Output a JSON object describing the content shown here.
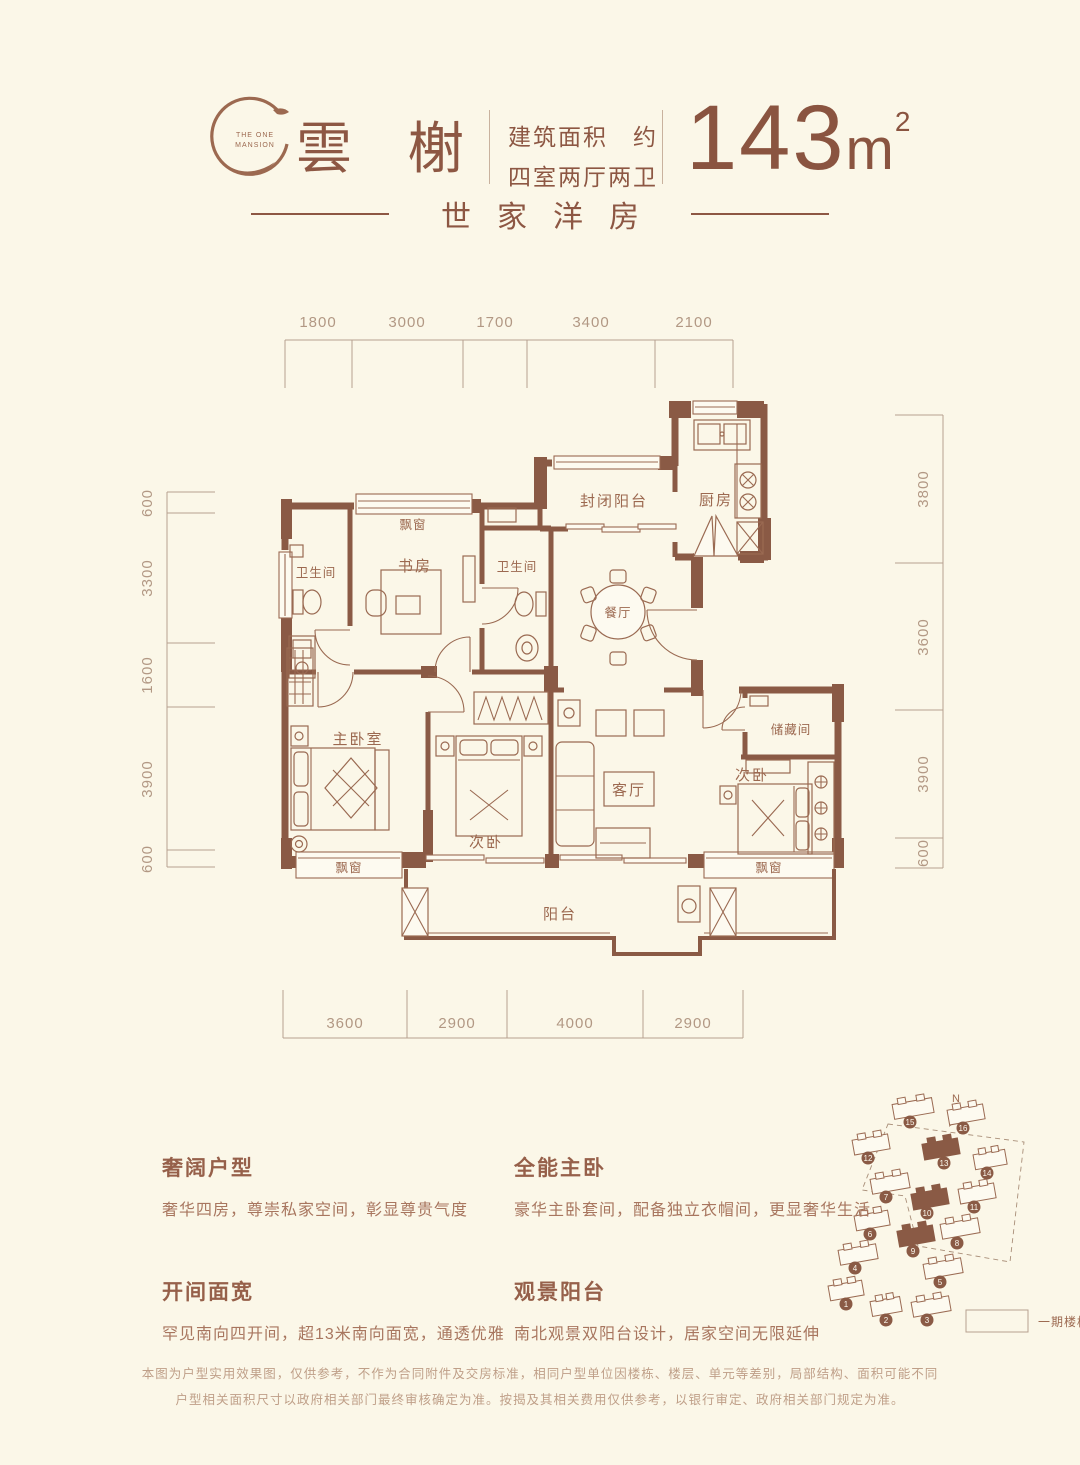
{
  "header": {
    "logo_line1": "THE ONE",
    "logo_line2": "MANSION",
    "title": "雲榭",
    "area_label_line1": "建筑面积　约",
    "area_label_line2": "四室两厅两卫",
    "area_value": "143",
    "area_unit": "m",
    "area_sup": "2",
    "subtitle": "世家洋房"
  },
  "dimensions": {
    "top": [
      "1800",
      "3000",
      "1700",
      "3400",
      "2100"
    ],
    "left": [
      "600",
      "3300",
      "1600",
      "3900",
      "600"
    ],
    "right": [
      "3800",
      "3600",
      "3900",
      "600"
    ],
    "bottom": [
      "3600",
      "2900",
      "4000",
      "2900"
    ]
  },
  "rooms": {
    "bath_left": "卫生间",
    "bay_top": "飘窗",
    "study": "书房",
    "bath_mid": "卫生间",
    "enclosed_balcony": "封闭阳台",
    "kitchen": "厨房",
    "dining": "餐厅",
    "master": "主卧室",
    "bedroom_mid": "次卧",
    "living": "客厅",
    "storage": "储藏间",
    "bedroom_right": "次卧",
    "bay_left": "飘窗",
    "bay_right": "飘窗",
    "balcony": "阳台"
  },
  "features": [
    {
      "title": "奢阔户型",
      "desc": "奢华四房，尊崇私家空间，彰显尊贵气度"
    },
    {
      "title": "全能主卧",
      "desc": "豪华主卧套间，配备独立衣帽间，更显奢华生活"
    },
    {
      "title": "开间面宽",
      "desc": "罕见南向四开间，超13米南向面宽，通透优雅"
    },
    {
      "title": "观景阳台",
      "desc": "南北观景双阳台设计，居家空间无限延伸"
    }
  ],
  "siteplan": {
    "north_label": "N",
    "legend": "一期楼栋",
    "buildings": [
      {
        "number": "1",
        "filled": false
      },
      {
        "number": "2",
        "filled": false
      },
      {
        "number": "3",
        "filled": false
      },
      {
        "number": "4",
        "filled": false
      },
      {
        "number": "5",
        "filled": false
      },
      {
        "number": "6",
        "filled": false
      },
      {
        "number": "9",
        "filled": true
      },
      {
        "number": "8",
        "filled": false
      },
      {
        "number": "7",
        "filled": false
      },
      {
        "number": "10",
        "filled": true
      },
      {
        "number": "11",
        "filled": false
      },
      {
        "number": "12",
        "filled": false
      },
      {
        "number": "13",
        "filled": true
      },
      {
        "number": "14",
        "filled": false
      },
      {
        "number": "15",
        "filled": false
      },
      {
        "number": "16",
        "filled": false
      }
    ]
  },
  "disclaimer": [
    "本图为户型实用效果图，仅供参考，不作为合同附件及交房标准，相同户型单位因楼栋、楼层、单元等差别，局部结构、面积可能不同",
    "户型相关面积尺寸以政府相关部门最终审核确定为准。按揭及其相关费用仅供参考，以银行审定、政府相关部门规定为准。"
  ],
  "colors": {
    "background": "#fbf7e8",
    "wall_brown": "#8a5a45",
    "label_brown": "#9c6950",
    "title_brown": "#8d5743",
    "dim_taupe": "#b29884"
  }
}
